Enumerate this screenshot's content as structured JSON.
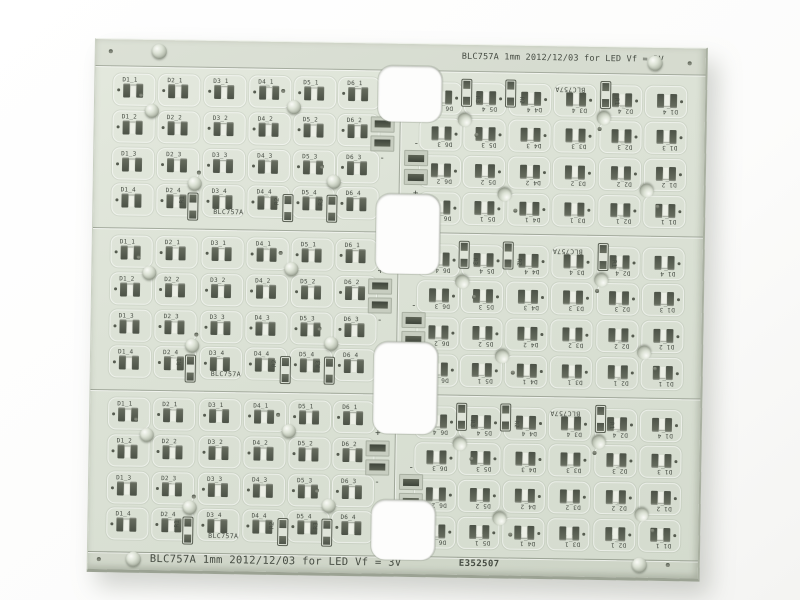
{
  "panel": {
    "top_rail_text": "BLC757A 1mm 2012/12/03 for LED Vf = 3V",
    "bottom_rail_text": "BLC757A 1mm 2012/12/03 for LED Vf = 3V",
    "serial_text": "E352507",
    "board_silkscreen_label": "BLC757A",
    "polarity_positive": "+",
    "polarity_negative": "-",
    "led_designators": [
      [
        "D1_1",
        "D2_1",
        "D3_1",
        "D4_1",
        "D5_1",
        "D6_1"
      ],
      [
        "D1_2",
        "D2_2",
        "D3_2",
        "D4_2",
        "D5_2",
        "D6_2"
      ],
      [
        "D1_3",
        "D2_3",
        "D3_3",
        "D4_3",
        "D5_3",
        "D6_3"
      ],
      [
        "D1_4",
        "D2_4",
        "D3_4",
        "D4_4",
        "D5_4",
        "D6_4"
      ]
    ],
    "resistor_designators": [
      "R1",
      "R2",
      "R3"
    ],
    "colors": {
      "background": "#fdfdfc",
      "board_surface": "#dce2d6",
      "rail_tint": "#d3dacd",
      "silkscreen": "#474d44",
      "pad_dark": "#545a4e",
      "pad_metal": "#c7cdc0",
      "edge_shadow": "#9ba293"
    }
  }
}
